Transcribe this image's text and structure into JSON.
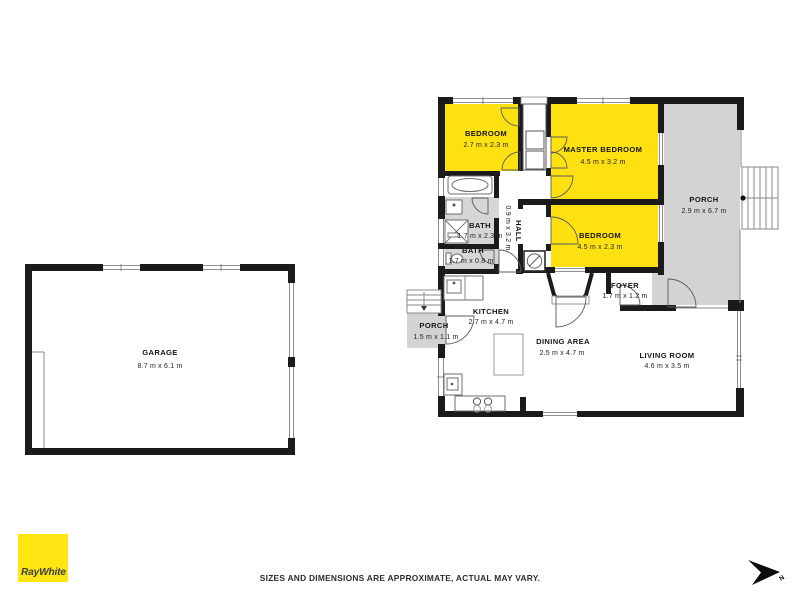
{
  "page": {
    "background": "#ffffff"
  },
  "branding": {
    "agency": "RayWhite",
    "logo_bg": "#FFE512",
    "logo_text_color": "#3F3F3F"
  },
  "footer": {
    "disclaimer": "SIZES AND DIMENSIONS ARE APPROXIMATE, ACTUAL MAY VARY."
  },
  "compass": {
    "label": "N"
  },
  "colors": {
    "highlight_yellow": "#FFE112",
    "porch_gray": "#D3D3D3",
    "bath_gray": "#D6D6D6",
    "wall_black": "#1B1B1B"
  },
  "rooms": {
    "garage": {
      "name": "GARAGE",
      "dims": "8.7 m x 6.1 m"
    },
    "bedroom_top": {
      "name": "BEDROOM",
      "dims": "2.7 m x 2.3 m"
    },
    "master_bedroom": {
      "name": "MASTER BEDROOM",
      "dims": "4.5 m x 3.2 m"
    },
    "bedroom_mid": {
      "name": "BEDROOM",
      "dims": "4.5 m x 2.3 m"
    },
    "porch_right": {
      "name": "PORCH",
      "dims": "2.9 m x 6.7 m"
    },
    "bath_large": {
      "name": "BATH",
      "dims": "1.7 m x 2.3 m"
    },
    "bath_small": {
      "name": "BATH",
      "dims": "1.7 m x 0.8 m"
    },
    "hall": {
      "name": "HALL",
      "dims": "0.9 m x 3.2 m"
    },
    "foyer": {
      "name": "FOYER",
      "dims": "1.7 m x 1.2 m"
    },
    "kitchen": {
      "name": "KITCHEN",
      "dims": "2.7 m x 4.7 m"
    },
    "porch_left": {
      "name": "PORCH",
      "dims": "1.5 m x 1.1 m"
    },
    "dining": {
      "name": "DINING AREA",
      "dims": "2.5 m x 4.7 m"
    },
    "living": {
      "name": "LIVING ROOM",
      "dims": "4.6 m x 3.5 m"
    }
  }
}
